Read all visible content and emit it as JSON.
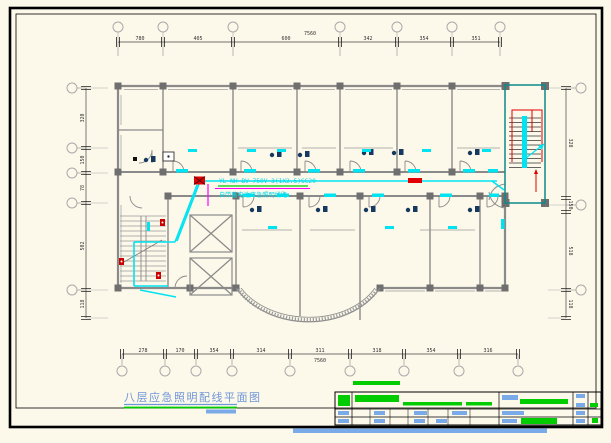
{
  "drawing": {
    "title": "八层应急照明配线平面图",
    "type_note": "CAD emergency lighting wiring floor plan"
  },
  "annotation": {
    "line1": "YL NH-BV-750V-3(1X2.5)SC20",
    "line2": "自带蓄电池应急照明线路"
  },
  "dimensions": {
    "top": {
      "overall": "7560",
      "segments": [
        "780",
        "405",
        "600",
        "342",
        "354",
        "351"
      ]
    },
    "bottom": {
      "overall": "7560",
      "segments": [
        "278",
        "170",
        "354",
        "314",
        "311",
        "318",
        "354",
        "316"
      ]
    },
    "left": {
      "segments": [
        "320",
        "150",
        "78",
        "502",
        "118"
      ]
    },
    "right": {
      "segments": [
        "328",
        "150",
        "518",
        "118"
      ]
    }
  },
  "colors": {
    "background": "#fcf8ea",
    "frame": "#000000",
    "wall_gray": "#8a8a8a",
    "column_gray": "#6f6f6f",
    "wiring_cyan": "#00e4f2",
    "device_red": "#e00000",
    "leader_magenta": "#ff00ff",
    "underline_green": "#00cc00",
    "text_blue": "#6f96d8",
    "fixture_navy": "#16395f",
    "stair_teal": "#0d8a8a",
    "titleblock_blue": "#7aabe8"
  }
}
